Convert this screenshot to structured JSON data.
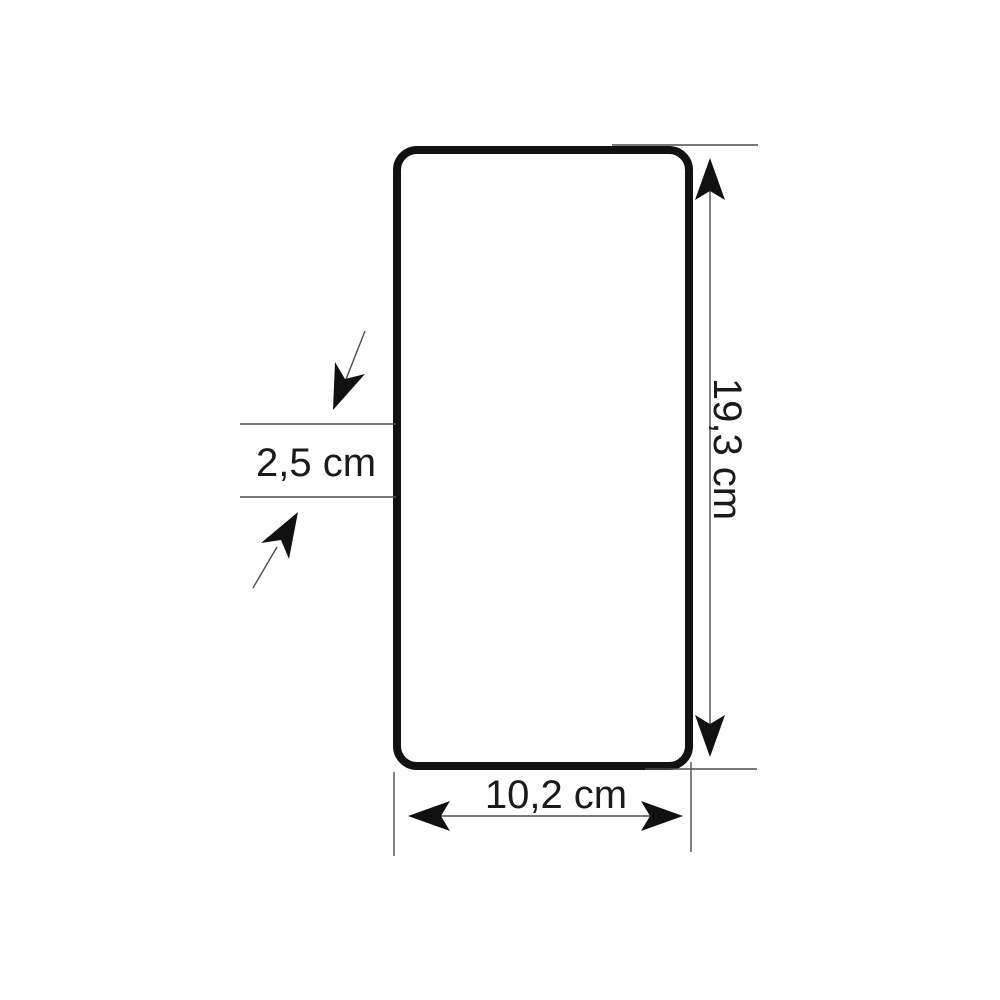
{
  "diagram": {
    "type": "dimension-drawing",
    "shape": "rounded-rectangle",
    "labels": {
      "height": "19,3 cm",
      "width": "10,2 cm",
      "side_detail": "2,5 cm"
    },
    "colors": {
      "outline": "#111111",
      "lines": "#4d4d4d",
      "text": "#1a1a1a",
      "background": "#ffffff"
    }
  }
}
